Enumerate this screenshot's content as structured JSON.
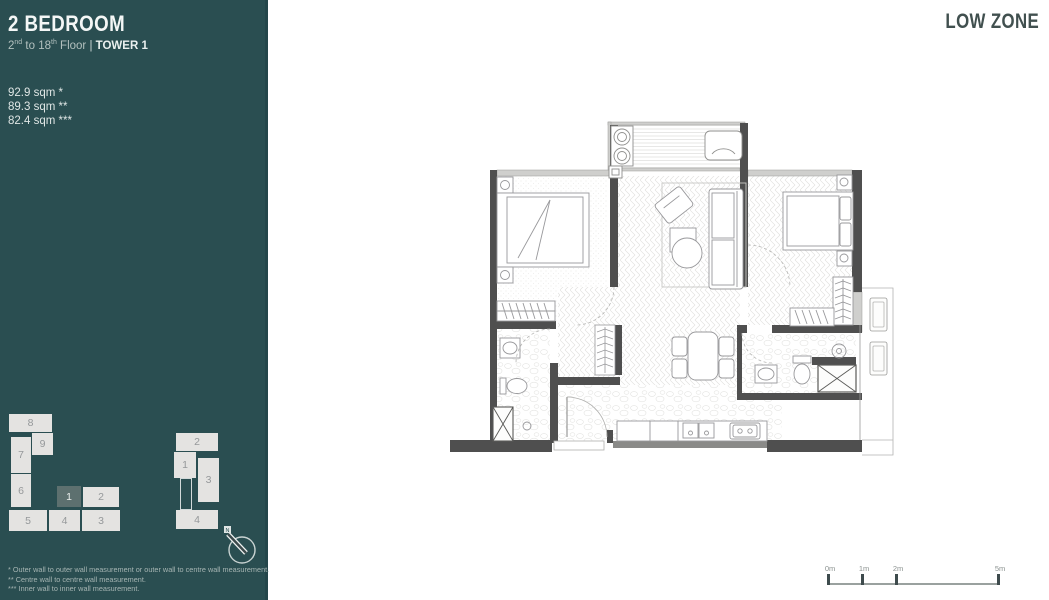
{
  "sidebar": {
    "bg_color": "#2a4e51",
    "title": "2 BEDROOM",
    "floor_line": {
      "from": "2",
      "from_sup": "nd",
      "mid": "to",
      "to": "18",
      "to_sup": "th",
      "tail": "Floor",
      "sep": "|",
      "tower": "TOWER 1"
    },
    "areas": [
      "92.9 sqm *",
      "89.3 sqm **",
      "82.4 sqm ***"
    ],
    "keyplan_tower1": {
      "highlight_color": "#5d706f",
      "units": [
        {
          "label": "8",
          "highlighted": false
        },
        {
          "label": "9",
          "highlighted": false
        },
        {
          "label": "7",
          "highlighted": false
        },
        {
          "label": "6",
          "highlighted": false
        },
        {
          "label": "1",
          "highlighted": true
        },
        {
          "label": "2",
          "highlighted": false
        },
        {
          "label": "5",
          "highlighted": false
        },
        {
          "label": "4",
          "highlighted": false
        },
        {
          "label": "3",
          "highlighted": false
        }
      ]
    },
    "keyplan_tower2": {
      "units": [
        {
          "label": "2",
          "highlighted": false
        },
        {
          "label": "1",
          "highlighted": false
        },
        {
          "label": "3",
          "highlighted": false
        },
        {
          "label": "4",
          "highlighted": false
        }
      ]
    },
    "compass": {
      "label": "N"
    },
    "footnotes": [
      "* Outer wall to outer wall measurement or  outer wall to centre wall measurement.",
      "** Centre wall to centre wall measurement.",
      "*** Inner wall to inner wall measurement."
    ]
  },
  "header": {
    "zone_label": "LOW ZONE"
  },
  "scale_bar": {
    "labels": [
      "0m",
      "1m",
      "2m",
      "5m"
    ]
  },
  "colors": {
    "sidebar_teal": "#2a4e51",
    "wall_dark": "#4f4f4f",
    "wall_light": "#cfcfcd",
    "text_dark": "#41504f"
  }
}
